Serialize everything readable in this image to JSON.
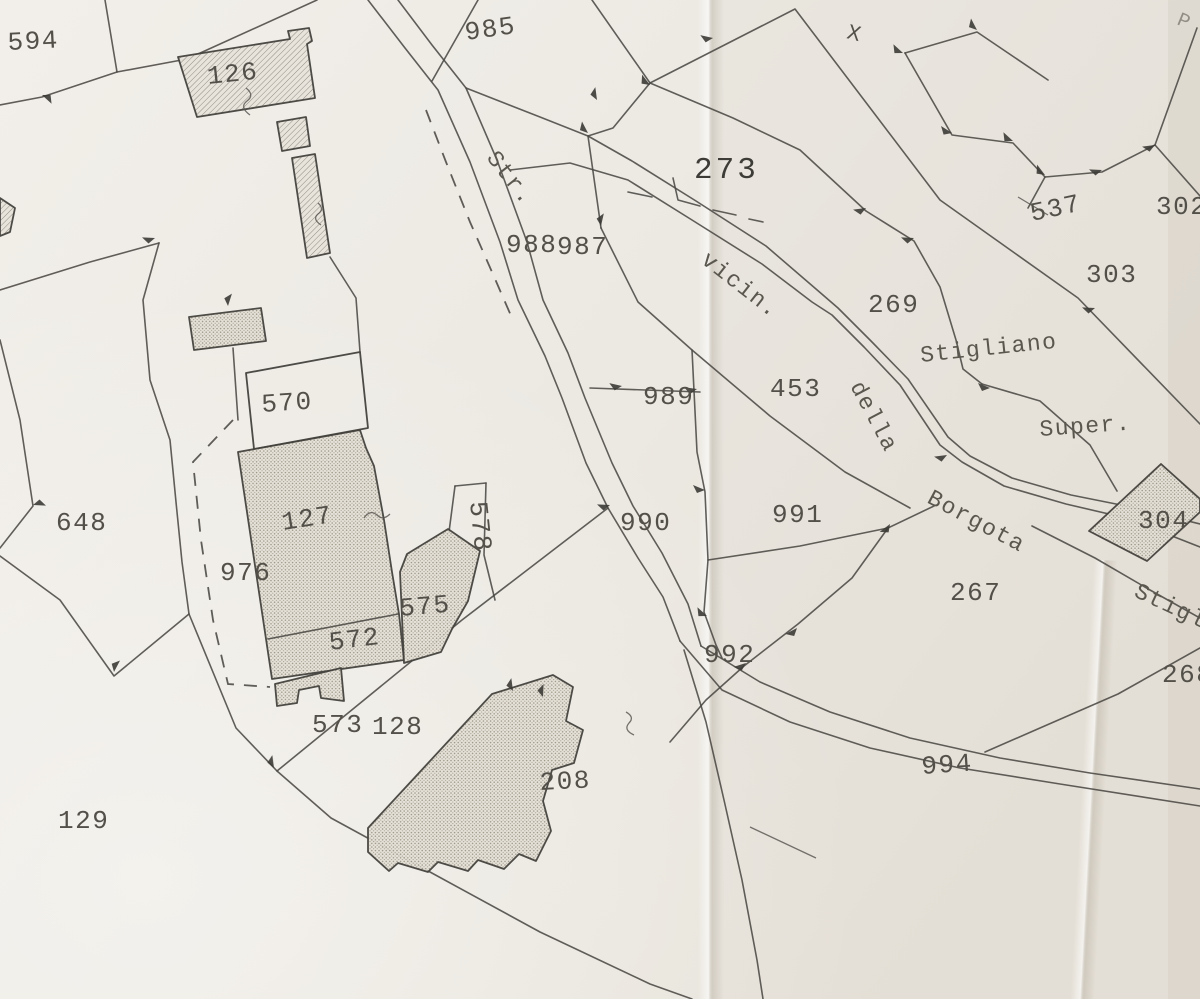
{
  "map": {
    "type": "cadastral-parcel-map",
    "colors": {
      "paper": "#ECE9E3",
      "ink": "#4B4944",
      "building_fill": "#E4E0D7",
      "hatch": "#827F77"
    },
    "labels": {
      "l594": "594",
      "l126": "126",
      "l985": "985",
      "l273": "273",
      "l537": "537",
      "l302": "302",
      "l303": "303",
      "l988": "988",
      "l987": "987",
      "l989": "989",
      "l990": "990",
      "l991": "991",
      "l992": "992",
      "l994": "994",
      "l269": "269",
      "l453": "453",
      "l267": "267",
      "l268": "268",
      "l304": "304",
      "l648": "648",
      "l570": "570",
      "l127": "127",
      "l976": "976",
      "l575": "575",
      "l572": "572",
      "l573": "573",
      "l578": "578",
      "l128": "128",
      "l129": "129",
      "l208": "208"
    },
    "street_words": {
      "str": "Str.",
      "vicin": "vicin.",
      "della": "della",
      "borgota": "Borgota",
      "stigliano": "Stigliano",
      "super": "Super.",
      "stigli_cut": "Stigli"
    },
    "symbols": {
      "x_mark": "X",
      "p_mark": "P"
    }
  }
}
